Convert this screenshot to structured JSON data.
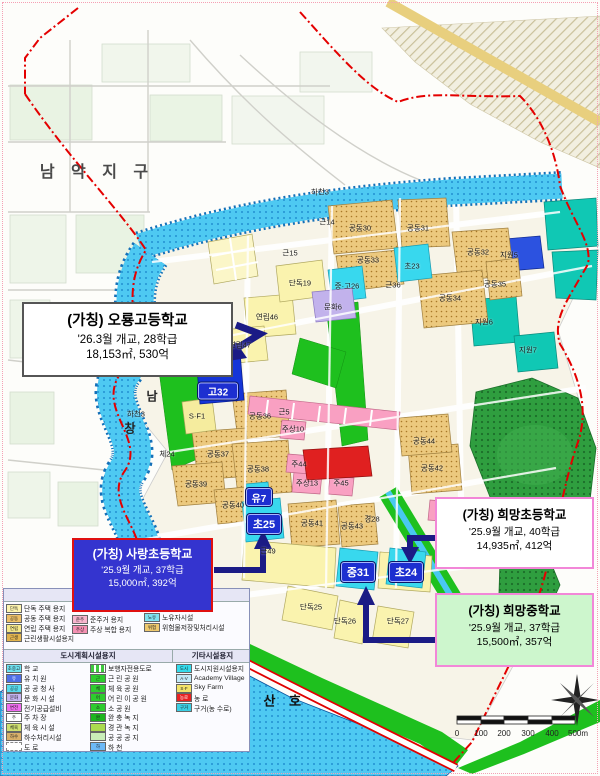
{
  "callouts": {
    "oryong": {
      "title": "(가칭) 오룡고등학교",
      "line1": "'26.3월 개교, 28학급",
      "line2": "18,153㎡, 530억"
    },
    "sarang": {
      "title": "(가칭) 사랑초등학교",
      "line1": "'25.9월 개교, 37학급",
      "line2": "15,000㎡, 392억"
    },
    "huimang_elem": {
      "title": "(가칭) 희망초등학교",
      "line1": "'25.9월 개교, 40학급",
      "line2": "14,935㎡, 412억"
    },
    "huimang_mid": {
      "title": "(가칭) 희망중학교",
      "line1": "'25.9월 개교, 37학급",
      "line2": "15,500㎡, 357억"
    }
  },
  "map": {
    "region_labels": [
      {
        "t": "남 악 지 구",
        "x": 97,
        "y": 170,
        "cls": "district"
      },
      {
        "t": "영 산 호",
        "x": 272,
        "y": 700,
        "cls": "lake"
      },
      {
        "t": "남",
        "x": 152,
        "y": 396,
        "cls": "river"
      },
      {
        "t": "창",
        "x": 130,
        "y": 428,
        "cls": "river"
      }
    ],
    "labels": [
      {
        "t": "하천3",
        "x": 320,
        "y": 192
      },
      {
        "t": "하천3",
        "x": 136,
        "y": 414
      },
      {
        "t": "근14",
        "x": 327,
        "y": 222
      },
      {
        "t": "근15",
        "x": 290,
        "y": 253
      },
      {
        "t": "공동30",
        "x": 360,
        "y": 228
      },
      {
        "t": "공동31",
        "x": 418,
        "y": 228
      },
      {
        "t": "공동32",
        "x": 478,
        "y": 252
      },
      {
        "t": "공동33",
        "x": 368,
        "y": 260
      },
      {
        "t": "공동34",
        "x": 450,
        "y": 298
      },
      {
        "t": "공동35",
        "x": 495,
        "y": 284
      },
      {
        "t": "초23",
        "x": 412,
        "y": 266
      },
      {
        "t": "중·고26",
        "x": 347,
        "y": 286
      },
      {
        "t": "근36",
        "x": 393,
        "y": 285
      },
      {
        "t": "단독19",
        "x": 300,
        "y": 283
      },
      {
        "t": "연립46",
        "x": 267,
        "y": 317
      },
      {
        "t": "연립47",
        "x": 240,
        "y": 345
      },
      {
        "t": "문화6",
        "x": 333,
        "y": 307
      },
      {
        "t": "지원5",
        "x": 509,
        "y": 255
      },
      {
        "t": "지원6",
        "x": 484,
        "y": 322
      },
      {
        "t": "지원7",
        "x": 528,
        "y": 350
      },
      {
        "t": "S·F1",
        "x": 197,
        "y": 416
      },
      {
        "t": "체24",
        "x": 167,
        "y": 454
      },
      {
        "t": "공동36",
        "x": 260,
        "y": 416
      },
      {
        "t": "근5",
        "x": 284,
        "y": 412
      },
      {
        "t": "주상10",
        "x": 293,
        "y": 429
      },
      {
        "t": "공동37",
        "x": 218,
        "y": 454
      },
      {
        "t": "공동38",
        "x": 258,
        "y": 469
      },
      {
        "t": "공동39",
        "x": 196,
        "y": 484
      },
      {
        "t": "공동40",
        "x": 233,
        "y": 505
      },
      {
        "t": "주44",
        "x": 299,
        "y": 464
      },
      {
        "t": "주상13",
        "x": 307,
        "y": 483
      },
      {
        "t": "주45",
        "x": 341,
        "y": 483
      },
      {
        "t": "공동41",
        "x": 312,
        "y": 523
      },
      {
        "t": "공동43",
        "x": 352,
        "y": 526
      },
      {
        "t": "공동42",
        "x": 432,
        "y": 468
      },
      {
        "t": "공동44",
        "x": 424,
        "y": 441
      },
      {
        "t": "근49",
        "x": 268,
        "y": 551
      },
      {
        "t": "경28",
        "x": 372,
        "y": 519
      },
      {
        "t": "단독25",
        "x": 311,
        "y": 607
      },
      {
        "t": "단독26",
        "x": 345,
        "y": 621
      },
      {
        "t": "단독27",
        "x": 398,
        "y": 621
      }
    ],
    "badges": [
      {
        "t": "고32",
        "x": 218,
        "y": 391,
        "cls": "b-g32"
      },
      {
        "t": "유7",
        "x": 259,
        "y": 497,
        "cls": "b-sm"
      },
      {
        "t": "초25",
        "x": 264,
        "y": 524,
        "cls": "b-md"
      },
      {
        "t": "중31",
        "x": 358,
        "y": 572,
        "cls": "b-md"
      },
      {
        "t": "초24",
        "x": 406,
        "y": 572,
        "cls": "b-md"
      }
    ]
  },
  "legend": {
    "header_housing": "주택건설용지",
    "header_city": "도시계획시설용지",
    "header_etc": "기타시설용지",
    "a1": [
      {
        "g": "단독",
        "t": "단독 주택 용지",
        "color": "#fdf4ae"
      },
      {
        "g": "공동",
        "t": "공동 주택 용지",
        "color": "#eec068",
        "cls": "dots"
      },
      {
        "g": "연립",
        "t": "연립 주택 용지",
        "color": "#f6e88a"
      },
      {
        "g": "근생",
        "t": "근린생활시설용지",
        "color": "#e2b44e",
        "cls": "dots"
      }
    ],
    "a2": [
      {
        "g": "준주",
        "t": "준주거 용지",
        "color": "#f8b6ce"
      },
      {
        "g": "주상",
        "t": "주상 복합 용지",
        "color": "#f490b2",
        "cls": "dots"
      }
    ],
    "a3": [
      {
        "g": "노유",
        "t": "노유자시설",
        "color": "#7fe2ef"
      },
      {
        "g": "위험",
        "t": "위험물저장및처리시설",
        "color": "#eec96e"
      }
    ],
    "b1": [
      {
        "g": "초중고",
        "t": "학  교",
        "color": "#6fe3f2"
      },
      {
        "g": "유",
        "t": "유 치 원",
        "color": "#4f6fe8",
        "cls": "wtx"
      },
      {
        "g": "공공",
        "t": "공 공 청 사",
        "color": "#57dcef"
      },
      {
        "g": "문화",
        "t": "문 화 시 설",
        "color": "#c6b5f2"
      },
      {
        "g": "변전",
        "t": "전기공급설비",
        "color": "#f06df0"
      },
      {
        "g": "주",
        "t": "주 차 장",
        "color": "#ffffff"
      },
      {
        "g": "체육",
        "t": "체 육 시 설",
        "color": "#cfe070",
        "cls": "dots2"
      },
      {
        "g": "하수",
        "t": "하수처리시설",
        "color": "#d9b06a"
      },
      {
        "g": "",
        "t": "도  로",
        "color": "#ffffff",
        "cls": "dash"
      }
    ],
    "b2": [
      {
        "g": "",
        "t": "보행자전용도로",
        "color": "#4ec83e",
        "cls": "gdash"
      },
      {
        "g": "근",
        "t": "근 린 공 원",
        "color": "#2ecc2e"
      },
      {
        "g": "체",
        "t": "체 육 공 원",
        "color": "#2ecc2e"
      },
      {
        "g": "어",
        "t": "어 린 이 공 원",
        "color": "#2ecc2e"
      },
      {
        "g": "소",
        "t": "소 공 원",
        "color": "#2ecc2e"
      },
      {
        "g": "완",
        "t": "완 충 녹 지",
        "color": "#1db51d"
      },
      {
        "g": "",
        "t": "경 관 녹 지",
        "color": "#aada4e",
        "cls": "dots2"
      },
      {
        "g": "",
        "t": "공 공 공 지",
        "color": "#c9eeb8",
        "cls": "dots3"
      },
      {
        "g": "하",
        "t": "하  천",
        "color": "#6db9f7"
      }
    ],
    "b3": [
      {
        "g": "도시",
        "t": "도시지원시설용지",
        "color": "#35dcec"
      },
      {
        "g": "A·V",
        "t": "Academy Village",
        "color": "#c3e9f7"
      },
      {
        "g": "S·F",
        "t": "Sky Farm",
        "color": "#f3e469"
      },
      {
        "g": "농로",
        "t": "농  로",
        "color": "#e82222",
        "cls": "wtx"
      },
      {
        "g": "구거",
        "t": "구거(농 수로)",
        "color": "#3bcfe4"
      }
    ]
  },
  "scalebar": {
    "ticks": [
      {
        "t": "0",
        "x": 457
      },
      {
        "t": "100",
        "x": 481
      },
      {
        "t": "200",
        "x": 504
      },
      {
        "t": "300",
        "x": 528
      },
      {
        "t": "400",
        "x": 552
      },
      {
        "t": "500m",
        "x": 578
      }
    ]
  }
}
